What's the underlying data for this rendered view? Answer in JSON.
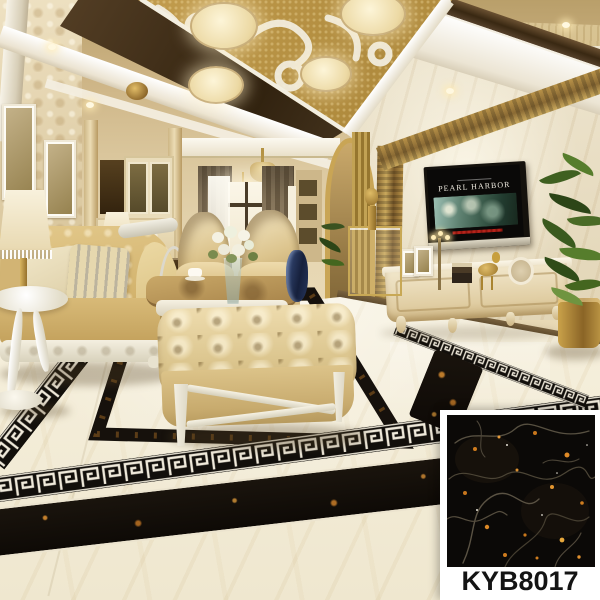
{
  "product": {
    "code": "KYB8017"
  },
  "tv": {
    "movie_title": "PEARL HARBOR"
  },
  "palette": {
    "swatch_tile_black": "#0c0a08",
    "swatch_vein_gold": "#d4821f",
    "floor_cream": "#f2ecd9",
    "inlay_black": "#16110c",
    "ceiling_gold": "#c09a4c",
    "sofa_gold": "#d6b97c",
    "swatch_panel_white": "#ffffff",
    "label_text": "#141414"
  }
}
